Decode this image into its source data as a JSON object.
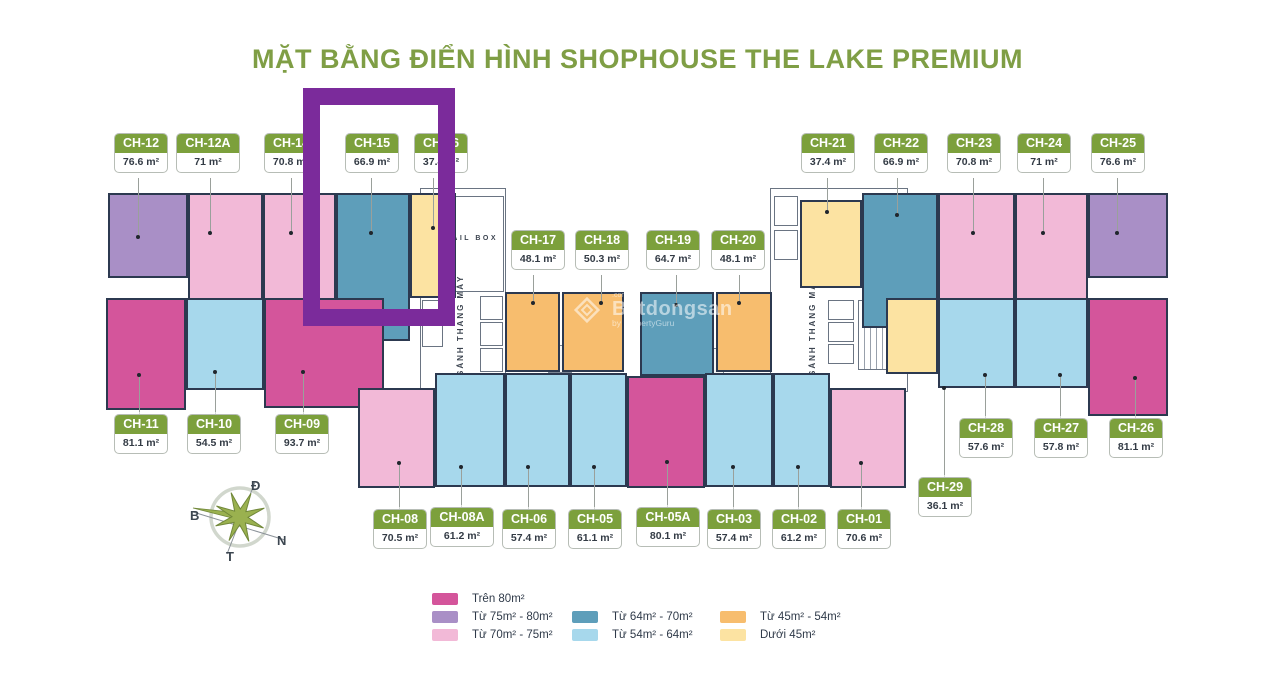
{
  "title": "MẶT BẰNG ĐIỂN HÌNH SHOPHOUSE THE LAKE PREMIUM",
  "units": [
    {
      "id": "CH-12",
      "area": "76.6 m²",
      "color": "#a98fc6"
    },
    {
      "id": "CH-12A",
      "area": "71 m²",
      "color": "#f2b9d7"
    },
    {
      "id": "CH-14",
      "area": "70.8 m²",
      "color": "#f2b9d7"
    },
    {
      "id": "CH-15",
      "area": "66.9 m²",
      "color": "#5e9eba"
    },
    {
      "id": "CH-16",
      "area": "37.4 m²",
      "color": "#fce3a2"
    },
    {
      "id": "CH-17",
      "area": "48.1 m²",
      "color": "#f7bd6e"
    },
    {
      "id": "CH-18",
      "area": "50.3 m²",
      "color": "#f7bd6e"
    },
    {
      "id": "CH-19",
      "area": "64.7 m²",
      "color": "#5e9eba"
    },
    {
      "id": "CH-20",
      "area": "48.1 m²",
      "color": "#f7bd6e"
    },
    {
      "id": "CH-21",
      "area": "37.4 m²",
      "color": "#fce3a2"
    },
    {
      "id": "CH-22",
      "area": "66.9 m²",
      "color": "#5e9eba"
    },
    {
      "id": "CH-23",
      "area": "70.8 m²",
      "color": "#f2b9d7"
    },
    {
      "id": "CH-24",
      "area": "71 m²",
      "color": "#f2b9d7"
    },
    {
      "id": "CH-25",
      "area": "76.6 m²",
      "color": "#a98fc6"
    },
    {
      "id": "CH-11",
      "area": "81.1 m²",
      "color": "#d4559b"
    },
    {
      "id": "CH-10",
      "area": "54.5 m²",
      "color": "#a7d8ec"
    },
    {
      "id": "CH-09",
      "area": "93.7 m²",
      "color": "#d4559b"
    },
    {
      "id": "CH-08",
      "area": "70.5 m²",
      "color": "#f2b9d7"
    },
    {
      "id": "CH-08A",
      "area": "61.2 m²",
      "color": "#a7d8ec"
    },
    {
      "id": "CH-06",
      "area": "57.4 m²",
      "color": "#a7d8ec"
    },
    {
      "id": "CH-05",
      "area": "61.1 m²",
      "color": "#a7d8ec"
    },
    {
      "id": "CH-05A",
      "area": "80.1 m²",
      "color": "#d4559b"
    },
    {
      "id": "CH-03",
      "area": "57.4 m²",
      "color": "#a7d8ec"
    },
    {
      "id": "CH-02",
      "area": "61.2 m²",
      "color": "#a7d8ec"
    },
    {
      "id": "CH-01",
      "area": "70.6 m²",
      "color": "#f2b9d7"
    },
    {
      "id": "CH-28",
      "area": "57.6 m²",
      "color": "#a7d8ec"
    },
    {
      "id": "CH-27",
      "area": "57.8 m²",
      "color": "#a7d8ec"
    },
    {
      "id": "CH-26",
      "area": "81.1 m²",
      "color": "#d4559b"
    },
    {
      "id": "CH-29",
      "area": "36.1 m²",
      "color": "#fce3a2"
    }
  ],
  "structure": {
    "mailbox": "MAIL BOX",
    "lobby_left": "SẢNH THANG MÁY",
    "lobby_right": "SẢNH THANG MÁY"
  },
  "legend": {
    "items": [
      {
        "label": "Trên 80m²",
        "color": "#d4559b"
      },
      {
        "label": "Từ 75m² - 80m²",
        "color": "#a98fc6"
      },
      {
        "label": "Từ 70m² - 75m²",
        "color": "#f2b9d7"
      },
      {
        "label": "Từ 64m² - 70m²",
        "color": "#5e9eba"
      },
      {
        "label": "Từ 54m² - 64m²",
        "color": "#a7d8ec"
      },
      {
        "label": "Từ 45m² - 54m²",
        "color": "#f7bd6e"
      },
      {
        "label": "Dưới 45m²",
        "color": "#fce3a2"
      }
    ]
  },
  "compass": {
    "top": "Đ",
    "left": "B",
    "right": "N",
    "bottom": "T"
  },
  "highlight_color": "#7b2b9b",
  "watermark": {
    "dotcom": ".com.vn",
    "brand": "Batdongsan",
    "tagline": "by PropertyGuru"
  }
}
